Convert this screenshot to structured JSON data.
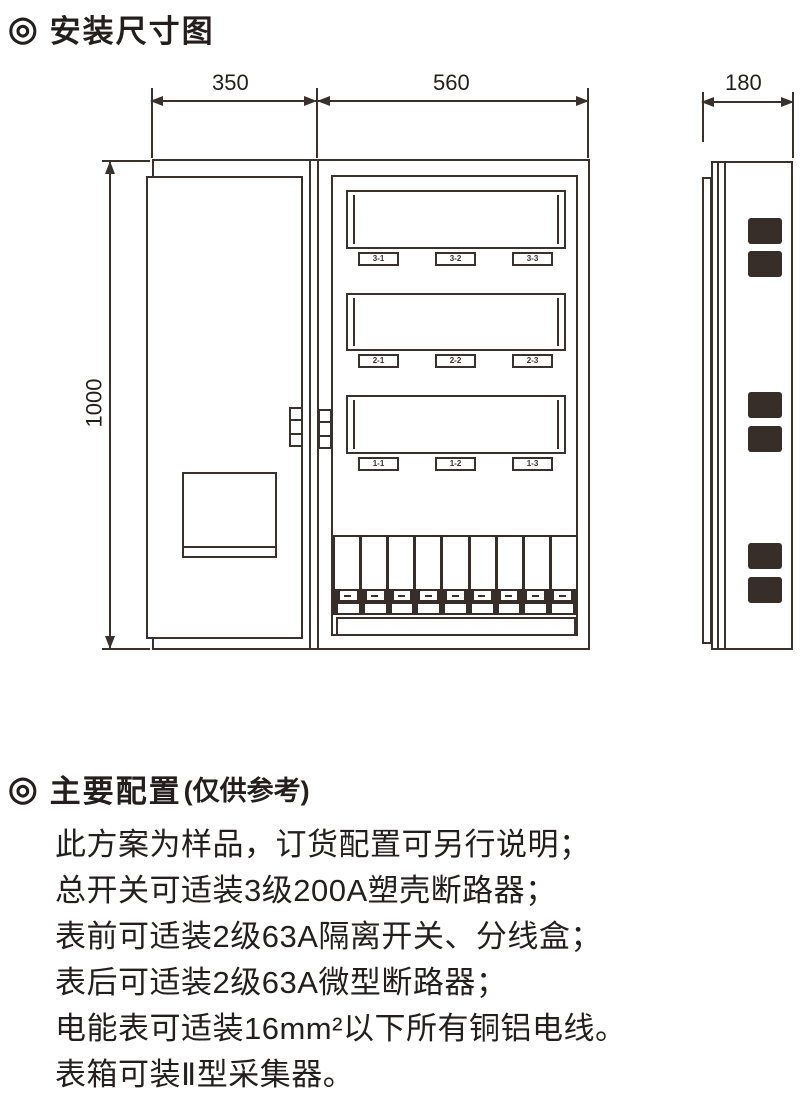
{
  "install_section": {
    "marker": "◎",
    "title": "安装尺寸图"
  },
  "dimensions": {
    "left_width": "350",
    "right_width": "560",
    "side_depth": "180",
    "height": "1000"
  },
  "front_view": {
    "meter_labels": [
      "3-1",
      "3-2",
      "3-3",
      "2-1",
      "2-2",
      "2-3",
      "1-1",
      "1-2",
      "1-3"
    ],
    "breaker_slots": 9
  },
  "config_section": {
    "marker": "◎",
    "title": "主要配置",
    "subtitle": "(仅供参考)",
    "lines": [
      "此方案为样品，订货配置可另行说明；",
      "总开关可适装3级200A塑壳断路器；",
      "表前可适装2级63A隔离开关、分线盒；",
      "表后可适装2级63A微型断路器；",
      "电能表可适装16mm²以下所有铜铝电线。",
      "表箱可装Ⅱ型采集器。"
    ]
  },
  "colors": {
    "line": "#3a312c",
    "dark_fill": "#382e29",
    "text": "#241f1c",
    "background": "#ffffff"
  }
}
